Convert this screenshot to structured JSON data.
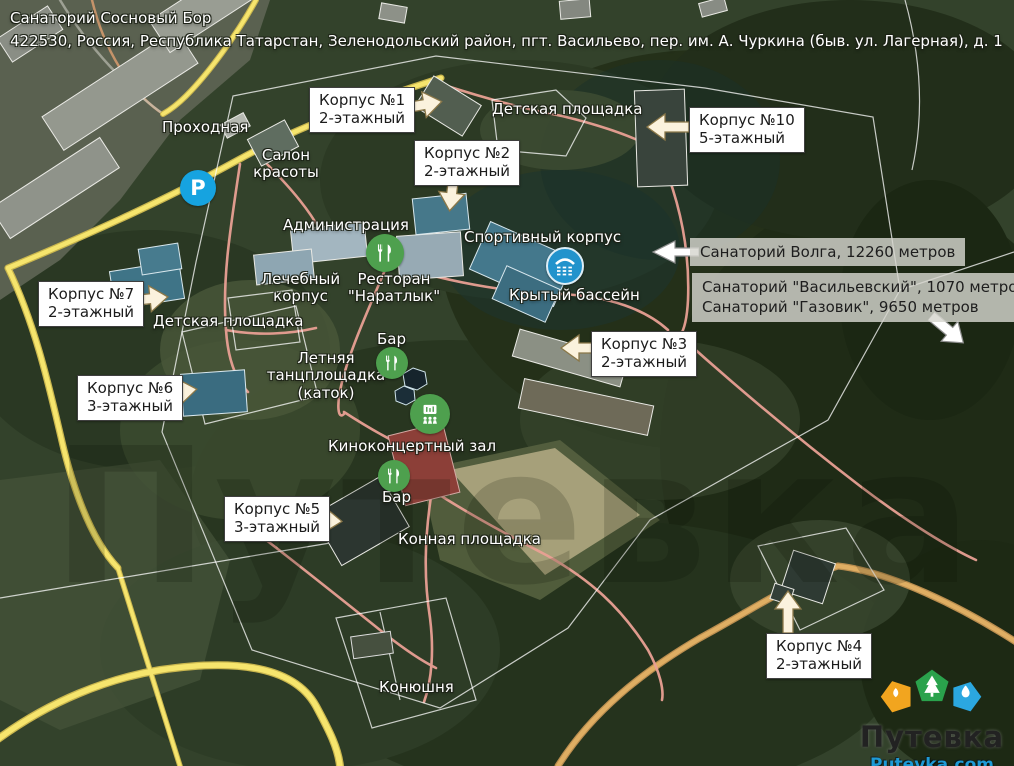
{
  "header": {
    "title": "Санаторий Сосновый Бор",
    "address": "422530, Россия, Республика Татарстан, Зеленодольский район, пгт. Васильево, пер. им. А. Чуркина (быв. ул. Лагерная), д. 1"
  },
  "map": {
    "watermark": "Путевка",
    "callouts": [
      {
        "name": "Корпус №1",
        "floors": "2-этажный"
      },
      {
        "name": "Корпус №2",
        "floors": "2-этажный"
      },
      {
        "name": "Корпус №10",
        "floors": "5-этажный"
      },
      {
        "name": "Корпус №7",
        "floors": "2-этажный"
      },
      {
        "name": "Корпус №6",
        "floors": "3-этажный"
      },
      {
        "name": "Корпус №3",
        "floors": "2-этажный"
      },
      {
        "name": "Корпус №5",
        "floors": "3-этажный"
      },
      {
        "name": "Корпус №4",
        "floors": "2-этажный"
      }
    ],
    "labels": [
      {
        "text": "Проходная"
      },
      {
        "text": "Салон\nкрасоты"
      },
      {
        "text": "Администрация"
      },
      {
        "text": "Детская площадка"
      },
      {
        "text": "Спортивный корпус"
      },
      {
        "text": "Лечебный\nкорпус"
      },
      {
        "text": "Ресторан\n\"Наратлык\""
      },
      {
        "text": "Крытый бассейн"
      },
      {
        "text": "Детская площадка"
      },
      {
        "text": "Бар"
      },
      {
        "text": "Летняя\nтанцплощадка\n(каток)"
      },
      {
        "text": "Киноконцертный зал"
      },
      {
        "text": "Бар"
      },
      {
        "text": "Конная площадка"
      },
      {
        "text": "Конюшня"
      }
    ],
    "info_boxes": [
      {
        "text": "Санаторий Волга, 12260 метров"
      },
      {
        "line1": "Санаторий \"Васильевский\", 1070 метров",
        "line2": "Санаторий \"Газовик\", 9650 метров"
      }
    ],
    "icons": {
      "parking_glyph": "P"
    },
    "colors": {
      "marker_green": "#4ea04e",
      "marker_blue": "#16a3e0",
      "road_yellow": "#f6e56d",
      "path_salmon": "#e9a094"
    }
  },
  "logo": {
    "name": "Путевка",
    "site": "Putevka.com"
  }
}
